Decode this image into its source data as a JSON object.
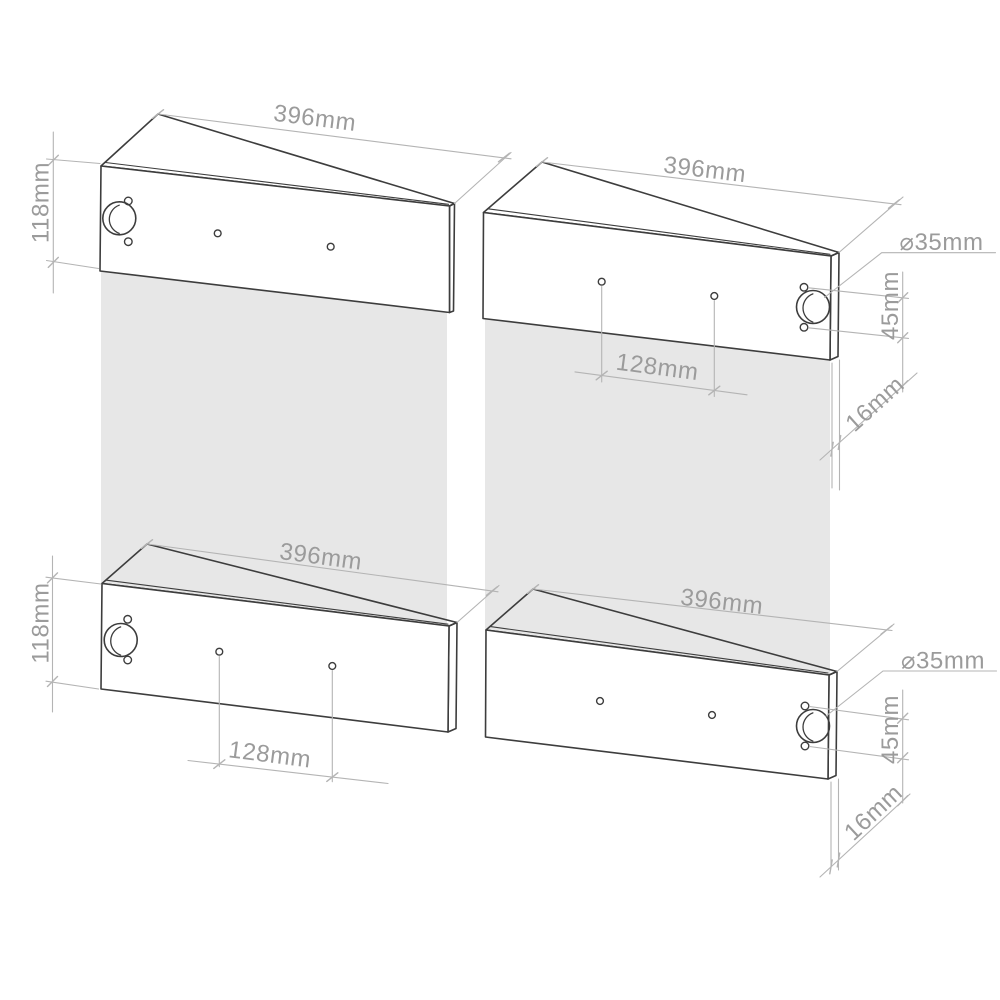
{
  "diagram": {
    "title": "panel-drilling-dimensions",
    "background": "#ffffff",
    "shadow_color": "#e7e7e7",
    "outline_color": "#3d3d3d",
    "dimension_color": "#b4b4b4",
    "text_color": "#9b9b9b",
    "panels": [
      {
        "name": "top-left",
        "width": "396mm",
        "height": "118mm"
      },
      {
        "name": "top-right",
        "width": "396mm",
        "hole_spacing": "128mm",
        "hole_diameter": "⌀35mm",
        "hole_offset": "45mm",
        "thickness": "16mm"
      },
      {
        "name": "bottom-left",
        "width": "396mm",
        "height": "118mm",
        "hole_spacing": "128mm"
      },
      {
        "name": "bottom-right",
        "width": "396mm",
        "hole_diameter": "⌀35mm",
        "hole_offset": "45mm",
        "thickness": "16mm"
      }
    ]
  }
}
